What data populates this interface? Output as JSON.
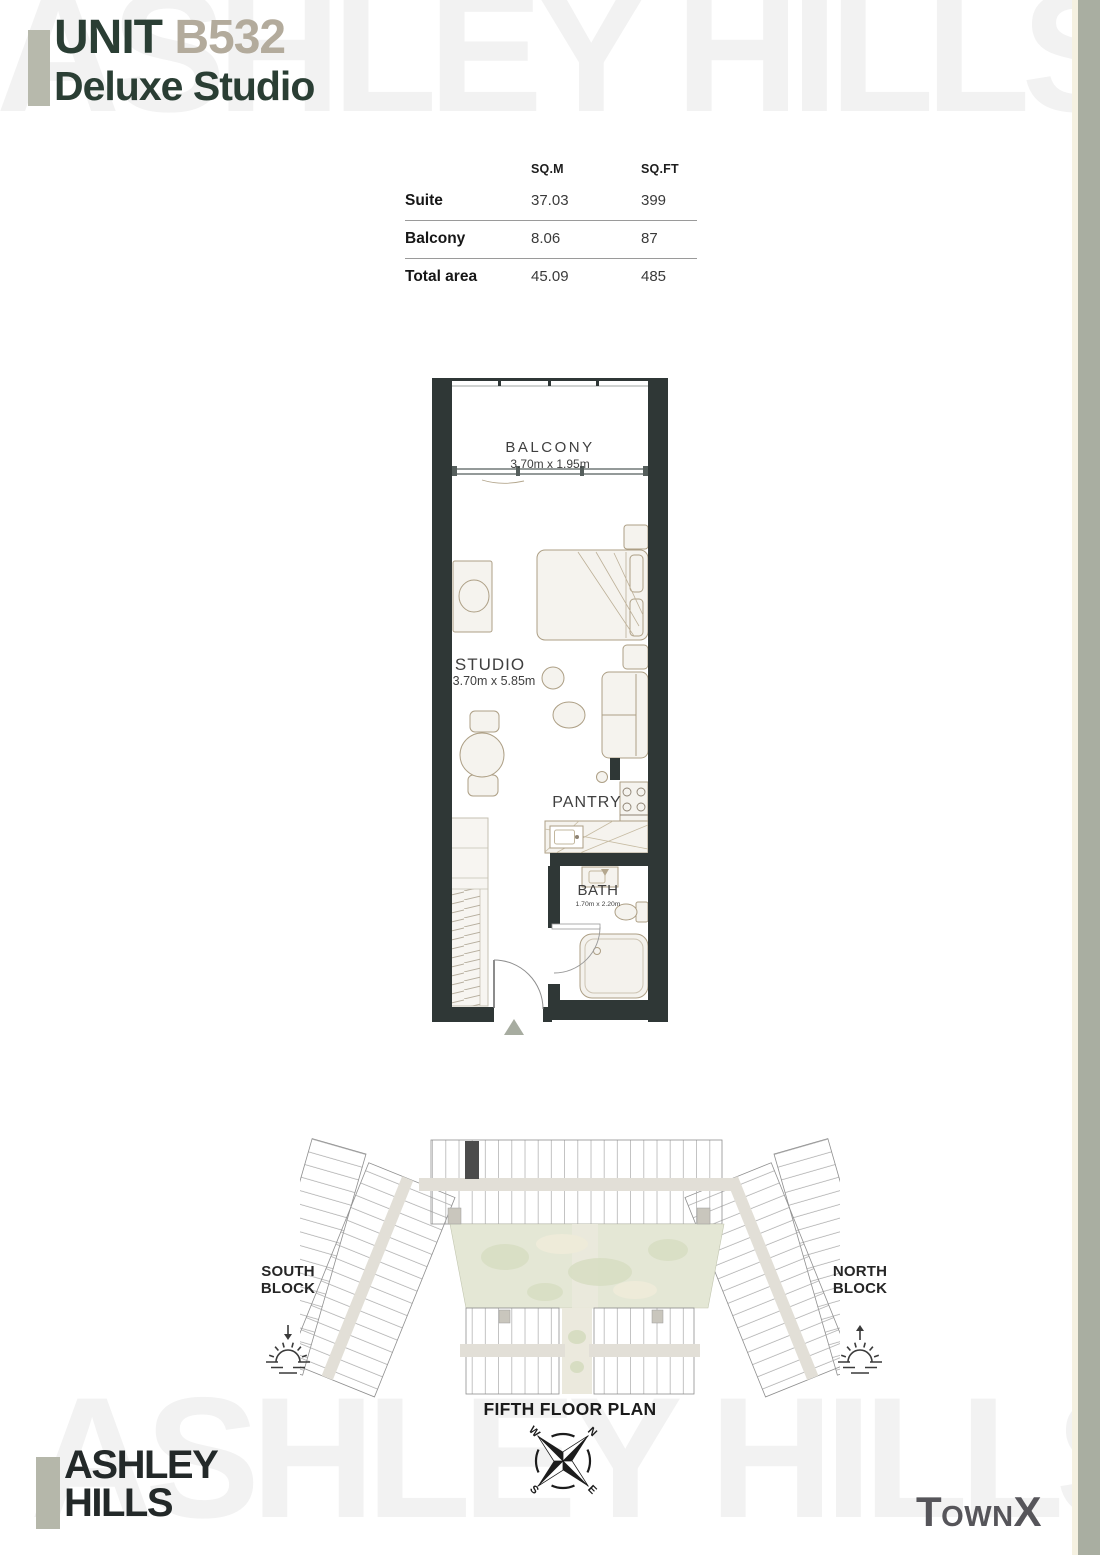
{
  "watermark": {
    "text": "ASHLEY HILLS",
    "color": "#f2f2f2"
  },
  "header": {
    "unit_label": "UNIT",
    "unit_number": "B532",
    "unit_type": "Deluxe Studio"
  },
  "area_table": {
    "columns": [
      "SQ.M",
      "SQ.FT"
    ],
    "rows": [
      {
        "label": "Suite",
        "sqm": "37.03",
        "sqft": "399"
      },
      {
        "label": "Balcony",
        "sqm": "8.06",
        "sqft": "87"
      },
      {
        "label": "Total area",
        "sqm": "45.09",
        "sqft": "485"
      }
    ]
  },
  "floor_plan": {
    "balcony": {
      "name": "BALCONY",
      "dims": "3.70m x 1.95m"
    },
    "studio": {
      "name": "STUDIO",
      "dims": "3.70m x 5.85m"
    },
    "pantry": {
      "name": "PANTRY"
    },
    "bath": {
      "name": "BATH",
      "dims": "1.70m x 2.20m"
    }
  },
  "site_plan": {
    "south_block": {
      "line1": "SOUTH",
      "line2": "BLOCK"
    },
    "north_block": {
      "line1": "NORTH",
      "line2": "BLOCK"
    },
    "caption": "FIFTH FLOOR PLAN",
    "compass": {
      "n": "N",
      "e": "E",
      "s": "S",
      "w": "W"
    }
  },
  "brand": {
    "line1": "ASHLEY",
    "line2": "HILLS"
  },
  "developer": {
    "t": "T",
    "own": "OWN",
    "x": "X"
  },
  "colors": {
    "accent_bar": "#b7b9ac",
    "title_green": "#2a3e34",
    "unit_number_taupe": "#b3ab9c",
    "wall_dark": "#2f3736",
    "furniture_tan": "#ad9f85",
    "site_highlight": "#4b4b4b",
    "courtyard_green": "#e4e7d5",
    "corridor_beige": "#e2dfd7",
    "edge_bar_sage": "#a9aea1",
    "edge_line_cream": "#f5f1e1"
  }
}
